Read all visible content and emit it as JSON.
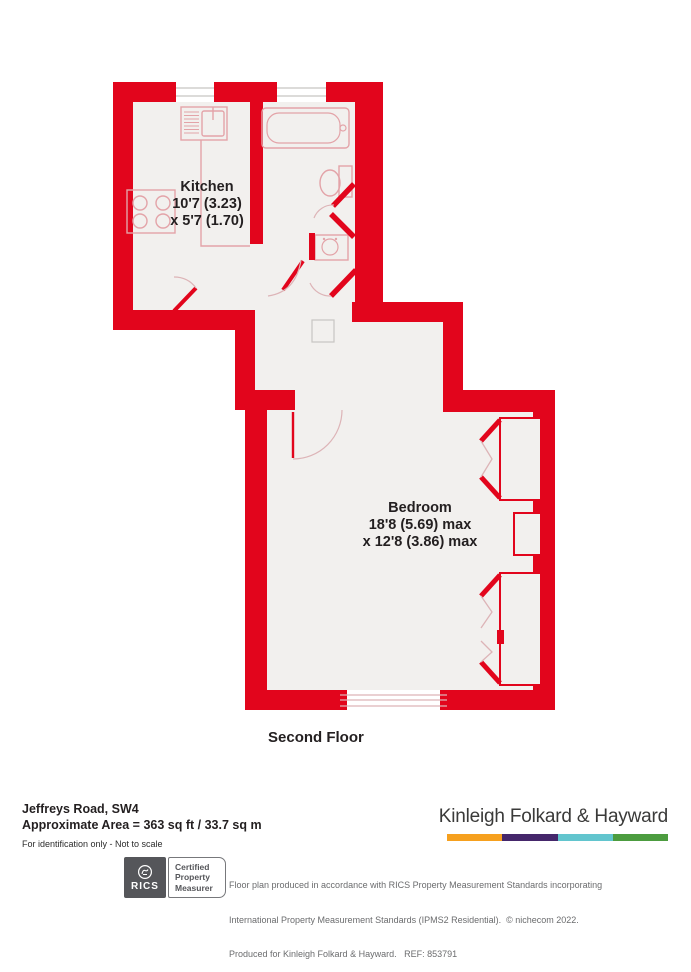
{
  "plan": {
    "floor_label": "Second Floor",
    "kitchen": {
      "name": "Kitchen",
      "dims_line1": "10'7 (3.23)",
      "dims_line2": "x 5'7 (1.70)"
    },
    "bedroom": {
      "name": "Bedroom",
      "dims_line1": "18'8 (5.69) max",
      "dims_line2": "x 12'8 (3.86) max"
    },
    "colors": {
      "wall": "#E2051C",
      "room_fill": "#F2F0EE"
    }
  },
  "footer": {
    "address": "Jeffreys Road, SW4",
    "area": "Approximate Area = 363 sq ft / 33.7 sq m",
    "disclaimer": "For identification only - Not to scale",
    "brand": {
      "name": "Kinleigh Folkard & Hayward",
      "bar_colors": [
        "#F6A01E",
        "#45276B",
        "#62C5CE",
        "#4C9C3F"
      ]
    },
    "rics_badge": {
      "abbr": "RICS",
      "label_lines": [
        "Certified",
        "Property",
        "Measurer"
      ]
    },
    "fine_print": [
      "Floor plan produced in accordance with RICS Property Measurement Standards incorporating",
      "International Property Measurement Standards (IPMS2 Residential).  © nichecom 2022.",
      "Produced for Kinleigh Folkard & Hayward.   REF: 853791"
    ]
  }
}
